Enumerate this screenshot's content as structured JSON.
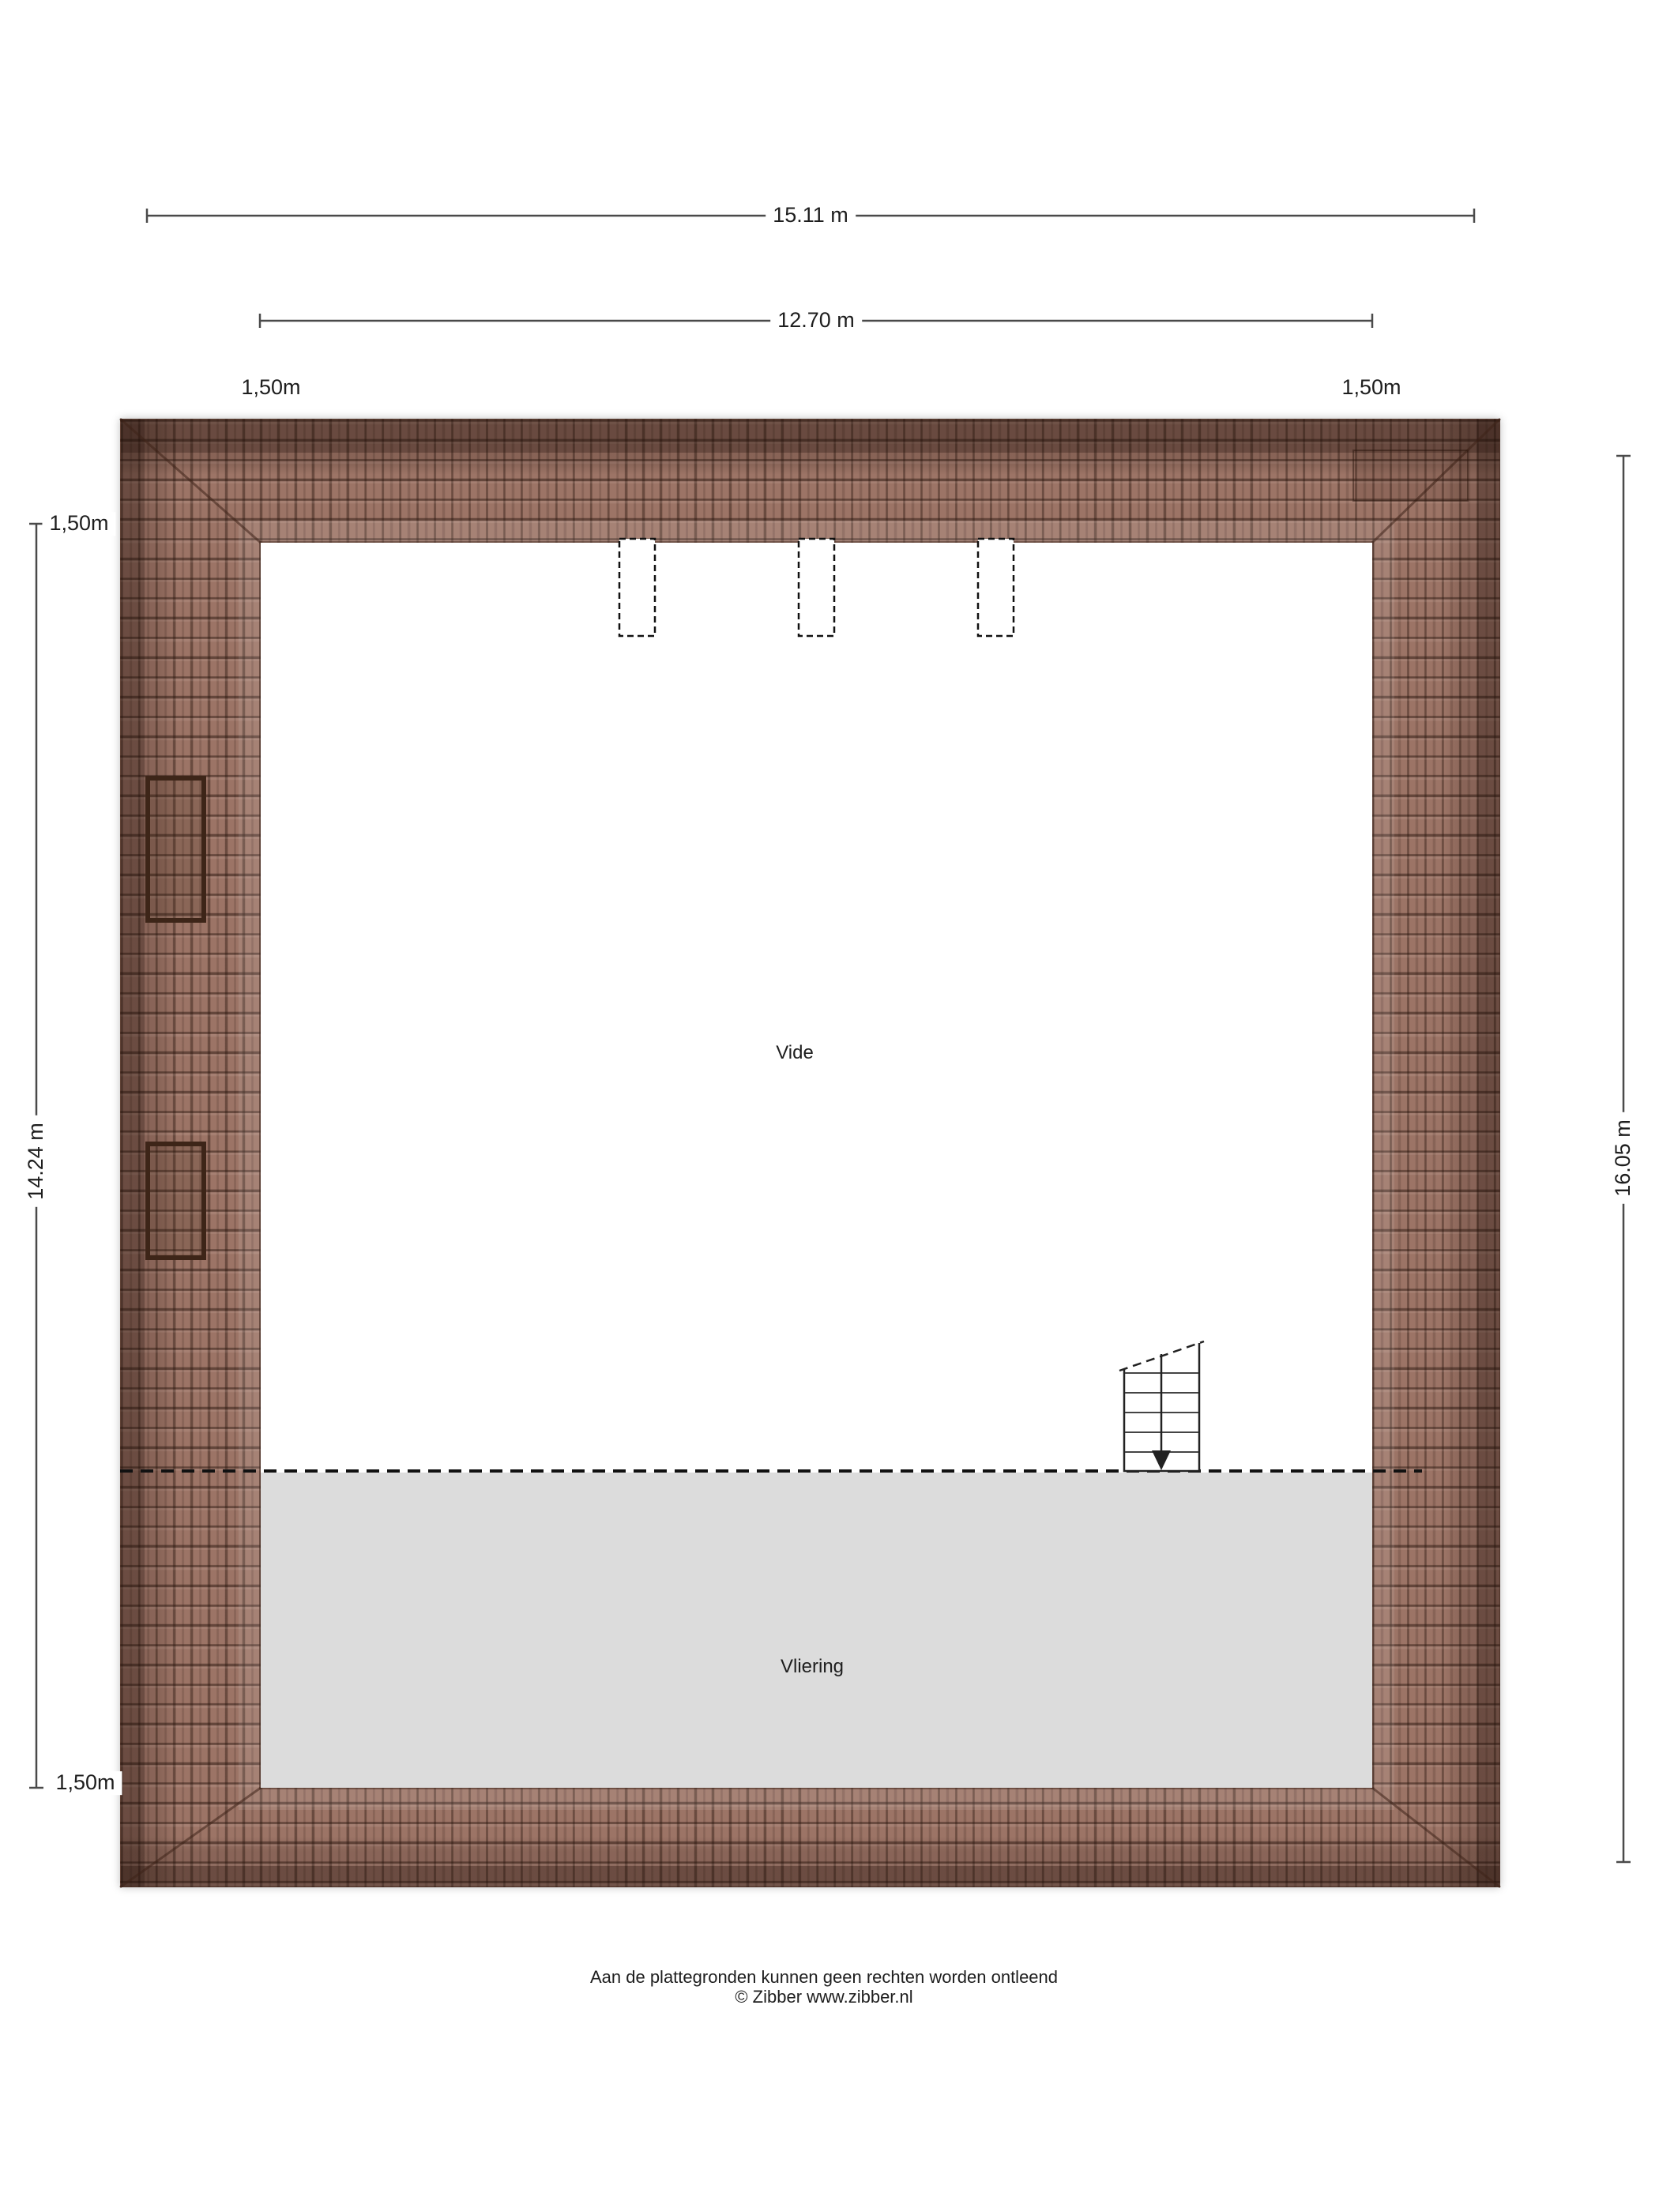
{
  "plan": {
    "type": "floorplan-roof-level",
    "room_vide": "Vide",
    "room_vliering": "Vliering"
  },
  "dimensions": {
    "total_width": "15.11 m",
    "inner_width": "12.70 m",
    "offset_top_left": "1,50m",
    "offset_top_right": "1,50m",
    "offset_left_upper": "1,50m",
    "offset_left_lower": "1,50m",
    "height_left": "14.24 m",
    "height_right": "16.05 m"
  },
  "footer": {
    "disclaimer": "Aan de plattegronden kunnen geen rechten worden ontleend",
    "credit": "© Zibber www.zibber.nl"
  },
  "colors": {
    "roof_tile": "#9c7466",
    "roof_edge_dark": "#5e4033",
    "vliering_fill": "#dcdcdc",
    "dimension_line": "#4a4a4a",
    "text": "#1e1e1e"
  }
}
